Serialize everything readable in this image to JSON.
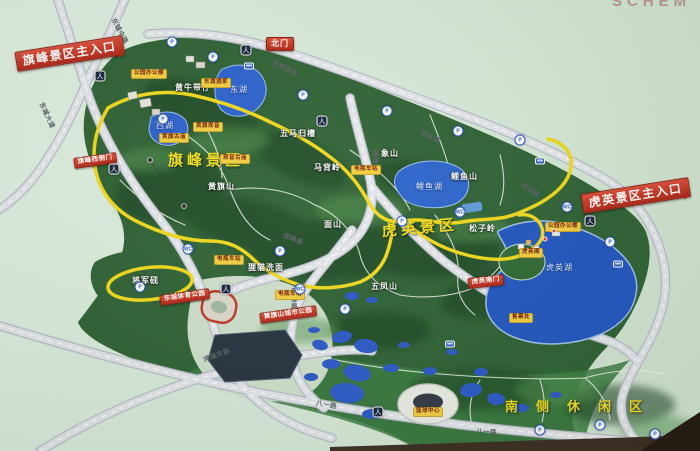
{
  "photo": {
    "partial_title": "SCHEM"
  },
  "colors": {
    "background_mint": "#d8eada",
    "terrain_green": "#2d5f33",
    "ridge_dark_green": "#163d1e",
    "water_blue": "#2355c4",
    "route_yellow": "#f2d919",
    "road_grey": "#dfe1e6",
    "sign_red": "#c0392b",
    "facility_sign_yellow": "#f3cf3e",
    "area_label_yellow": "#f2de1d"
  },
  "areas": [
    {
      "text": "旗峰景区",
      "x": 168,
      "y": 153,
      "name": "area-qifeng"
    },
    {
      "text": "虎英景区",
      "x": 382,
      "y": 224,
      "rot": -5,
      "name": "area-huying"
    },
    {
      "text": "南侧休闲区",
      "x": 505,
      "y": 400,
      "fs": 13,
      "ls": 18,
      "name": "area-south-leisure"
    }
  ],
  "peaks": [
    {
      "text": "黄牛带仔",
      "x": 175,
      "y": 84
    },
    {
      "text": "五马归槽",
      "x": 280,
      "y": 130
    },
    {
      "text": "马背岭",
      "x": 314,
      "y": 164
    },
    {
      "text": "黄旗山",
      "x": 208,
      "y": 183
    },
    {
      "text": "象山",
      "x": 381,
      "y": 150
    },
    {
      "text": "鲤鱼山",
      "x": 451,
      "y": 173
    },
    {
      "text": "松子岭",
      "x": 469,
      "y": 225
    },
    {
      "text": "面山",
      "x": 324,
      "y": 221
    },
    {
      "text": "五凤山",
      "x": 371,
      "y": 283
    },
    {
      "text": "狸猫洗面",
      "x": 248,
      "y": 264
    },
    {
      "text": "将军砚",
      "x": 132,
      "y": 277
    }
  ],
  "water_labels": [
    {
      "text": "东湖",
      "x": 230,
      "y": 86
    },
    {
      "text": "西湖",
      "x": 156,
      "y": 122
    },
    {
      "text": "鲤鱼湖",
      "x": 416,
      "y": 183
    },
    {
      "text": "虎英湖",
      "x": 546,
      "y": 264
    }
  ],
  "road_labels": [
    {
      "text": "东城中路",
      "x": 112,
      "y": 16,
      "rot": 62
    },
    {
      "text": "东城大道",
      "x": 40,
      "y": 100,
      "rot": 65
    },
    {
      "text": "东城南路",
      "x": 272,
      "y": 60,
      "rot": 26
    },
    {
      "text": "迎宾路",
      "x": 421,
      "y": 130,
      "rot": 27
    },
    {
      "text": "迎宾路",
      "x": 521,
      "y": 182,
      "rot": 33
    },
    {
      "text": "旗峰路",
      "x": 370,
      "y": 150,
      "cls": "vert"
    },
    {
      "text": "旗峰路",
      "x": 283,
      "y": 233,
      "rot": 22
    },
    {
      "text": "新源路",
      "x": 289,
      "y": 288,
      "cls": "vert"
    },
    {
      "text": "鸿福东路",
      "x": 204,
      "y": 358,
      "rot": -20
    },
    {
      "text": "八一路",
      "x": 316,
      "y": 401,
      "rot": 10
    },
    {
      "text": "八一路",
      "x": 476,
      "y": 429,
      "rot": 4
    }
  ],
  "gate_signs": [
    {
      "text": "旗峰景区主入口",
      "x": 16,
      "y": 52,
      "rot": -9,
      "cls": "big",
      "name": "sign-qifeng-main-entrance"
    },
    {
      "text": "北门",
      "x": 266,
      "y": 37,
      "name": "sign-north-gate"
    },
    {
      "text": "虎英景区主入口",
      "x": 582,
      "y": 194,
      "rot": -9,
      "cls": "big",
      "name": "sign-huying-main-entrance"
    },
    {
      "text": "旗峰西侧门",
      "x": 74,
      "y": 158,
      "rot": -8,
      "cls": "tiny",
      "name": "sign-qifeng-west-gate"
    },
    {
      "text": "东城体育公园",
      "x": 160,
      "y": 295,
      "rot": -8,
      "cls": "tiny",
      "name": "sign-dongcheng-sports-park"
    },
    {
      "text": "黄旗山城市公园",
      "x": 260,
      "y": 313,
      "rot": -8,
      "cls": "tiny",
      "name": "sign-huangqishan-city-park"
    },
    {
      "text": "虎英南门",
      "x": 468,
      "y": 278,
      "rot": -6,
      "cls": "tiny",
      "name": "sign-huying-south-gate"
    }
  ],
  "facility_signs": [
    {
      "text": "公园办公楼",
      "x": 131,
      "y": 69
    },
    {
      "text": "东湖酒家",
      "x": 201,
      "y": 78
    },
    {
      "text": "黄旗观音",
      "x": 193,
      "y": 122
    },
    {
      "text": "黄旗古庙",
      "x": 159,
      "y": 133
    },
    {
      "text": "观音古庙",
      "x": 220,
      "y": 154
    },
    {
      "text": "电瓶车站",
      "x": 351,
      "y": 165
    },
    {
      "text": "电瓶车站",
      "x": 214,
      "y": 255
    },
    {
      "text": "电瓶车站",
      "x": 275,
      "y": 290
    },
    {
      "text": "虎英阁",
      "x": 519,
      "y": 248
    },
    {
      "text": "公园办公楼",
      "x": 545,
      "y": 222
    },
    {
      "text": "售票处",
      "x": 509,
      "y": 313
    },
    {
      "text": "篮球中心",
      "x": 413,
      "y": 407
    }
  ],
  "markers": [
    {
      "x": 100,
      "y": 76,
      "cls": "gate",
      "glyph": "人",
      "name": "pedestrian-gate-icon"
    },
    {
      "x": 246,
      "y": 50,
      "cls": "gate",
      "glyph": "人",
      "name": "pedestrian-gate-icon"
    },
    {
      "x": 322,
      "y": 121,
      "cls": "gate",
      "glyph": "人",
      "name": "pedestrian-gate-icon"
    },
    {
      "x": 590,
      "y": 221,
      "cls": "gate",
      "glyph": "人",
      "name": "pedestrian-gate-icon"
    },
    {
      "x": 114,
      "y": 169,
      "cls": "gate",
      "glyph": "人",
      "name": "pedestrian-gate-icon"
    },
    {
      "x": 226,
      "y": 289,
      "cls": "gate",
      "glyph": "人",
      "name": "pedestrian-gate-icon"
    },
    {
      "x": 378,
      "y": 412,
      "cls": "gate",
      "glyph": "人",
      "name": "pedestrian-gate-icon"
    },
    {
      "x": 172,
      "y": 42,
      "cls": "badge",
      "glyph": "P",
      "name": "parking-icon"
    },
    {
      "x": 213,
      "y": 57,
      "cls": "badge",
      "glyph": "P",
      "name": "parking-icon"
    },
    {
      "x": 303,
      "y": 95,
      "cls": "badge",
      "glyph": "P",
      "name": "parking-icon"
    },
    {
      "x": 387,
      "y": 111,
      "cls": "badge",
      "glyph": "P",
      "name": "parking-icon"
    },
    {
      "x": 458,
      "y": 131,
      "cls": "badge",
      "glyph": "P",
      "name": "parking-icon"
    },
    {
      "x": 520,
      "y": 140,
      "cls": "badge",
      "glyph": "P",
      "name": "parking-icon"
    },
    {
      "x": 610,
      "y": 242,
      "cls": "badge",
      "glyph": "P",
      "name": "parking-icon"
    },
    {
      "x": 402,
      "y": 221,
      "cls": "badge",
      "glyph": "P",
      "name": "parking-icon"
    },
    {
      "x": 280,
      "y": 251,
      "cls": "badge",
      "glyph": "P",
      "name": "parking-icon"
    },
    {
      "x": 140,
      "y": 287,
      "cls": "badge",
      "glyph": "P",
      "name": "parking-icon"
    },
    {
      "x": 163,
      "y": 119,
      "cls": "badge",
      "glyph": "P",
      "name": "parking-icon"
    },
    {
      "x": 540,
      "y": 430,
      "cls": "badge",
      "glyph": "P",
      "name": "parking-icon"
    },
    {
      "x": 600,
      "y": 425,
      "cls": "badge",
      "glyph": "P",
      "name": "parking-icon"
    },
    {
      "x": 655,
      "y": 434,
      "cls": "badge",
      "glyph": "P",
      "name": "parking-icon"
    },
    {
      "x": 345,
      "y": 309,
      "cls": "badge",
      "glyph": "P",
      "name": "parking-icon"
    },
    {
      "x": 567,
      "y": 207,
      "cls": "badge",
      "glyph": "WC",
      "name": "toilet-icon"
    },
    {
      "x": 460,
      "y": 212,
      "cls": "badge",
      "glyph": "WC",
      "name": "toilet-icon"
    },
    {
      "x": 188,
      "y": 249,
      "cls": "badge",
      "glyph": "WC",
      "name": "toilet-icon"
    },
    {
      "x": 300,
      "y": 289,
      "cls": "badge",
      "glyph": "WC",
      "name": "toilet-icon"
    },
    {
      "x": 249,
      "y": 66,
      "cls": "bus",
      "glyph": "",
      "name": "bus-stop-icon"
    },
    {
      "x": 540,
      "y": 161,
      "cls": "bus",
      "glyph": "",
      "name": "bus-stop-icon"
    },
    {
      "x": 450,
      "y": 344,
      "cls": "bus",
      "glyph": "",
      "name": "bus-stop-icon"
    },
    {
      "x": 618,
      "y": 264,
      "cls": "bus",
      "glyph": "",
      "name": "bus-stop-icon"
    },
    {
      "x": 545,
      "y": 239,
      "cls": "dotr",
      "glyph": "",
      "name": "poi-dot-icon"
    },
    {
      "x": 554,
      "y": 231,
      "cls": "dotr",
      "glyph": "",
      "name": "poi-dot-icon"
    }
  ]
}
